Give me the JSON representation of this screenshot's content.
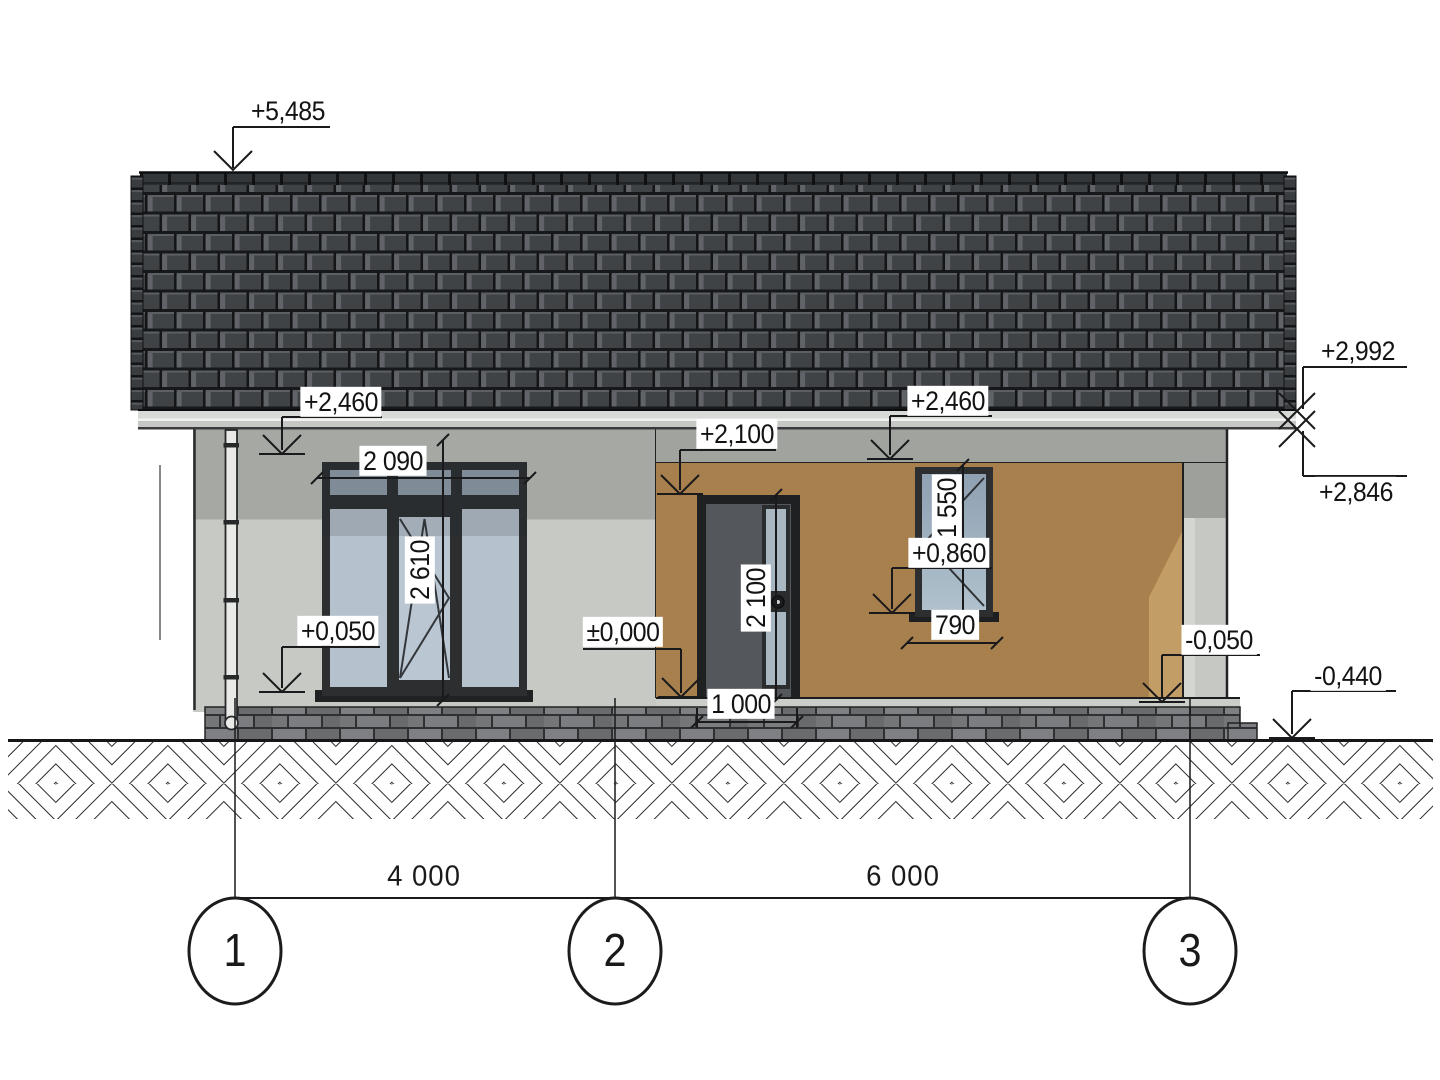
{
  "meta": {
    "drawing_type": "architectural front elevation",
    "subject": "single-storey house with gable tiled roof, recessed porch, entry door and two windows"
  },
  "elevation_marks": {
    "ridge": "+5,485",
    "eave_left": "+2,460",
    "eave_right": "+2,460",
    "eave_top_right": "+2,992",
    "eave_bottom_right": "+2,846",
    "door_top": "+2,100",
    "small_window_sill": "+0,860",
    "floor_left": "+0,050",
    "floor_zero": "±0,000",
    "porch_slab": "-0,050",
    "ground": "-0,440"
  },
  "dimensions": {
    "window_width": "2 090",
    "window_height": "2 610",
    "door_height": "2 100",
    "door_width": "1 000",
    "small_window_height": "1 550",
    "small_window_width": "790",
    "axis_span_1_2": "4 000",
    "axis_span_2_3": "6 000"
  },
  "axes": {
    "axis_1": "1",
    "axis_2": "2",
    "axis_3": "3"
  },
  "colors": {
    "roof_tile": "#3f4245",
    "fascia": "#d6d8d5",
    "wall_light": "#c7c9c4",
    "wall_shadow": "#a6a8a3",
    "porch_wall": "#a7804d",
    "porch_wall_lit": "#c39d66",
    "glass": "#b6c2cd",
    "frame": "#2c2e30",
    "door_leaf": "#54575b",
    "plinth_brick": "#737577",
    "line": "#1b1b1d"
  }
}
